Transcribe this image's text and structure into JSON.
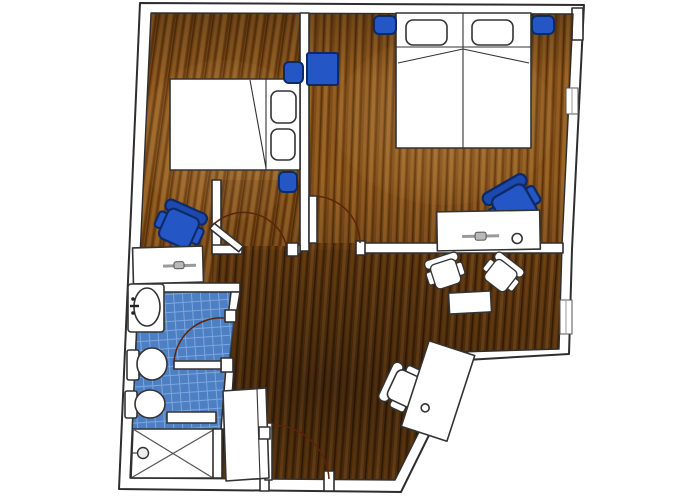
{
  "title": "apartment-floor-plan",
  "canvas": {
    "width": 700,
    "height": 500
  },
  "palette": {
    "wall_fill": "#ffffff",
    "wall_line": "#2e2e2e",
    "outline_dark": "#333333",
    "furniture_white": "#ffffff",
    "accent_blue": "#2456c6",
    "accent_blue_mid": "#1c49ad",
    "accent_blue_dark": "#0e2a66",
    "tile_base": "#4d7fc3",
    "tile_grid": "#7ea6dc",
    "wood_light_base": "#7f4d18",
    "wood_light_s1": "#935d22",
    "wood_light_s2": "#6a3a0e",
    "wood_light_s3": "#9a6527",
    "wood_light_s4": "#5c3309",
    "wood_dark_base": "#5b340e",
    "wood_dark_s1": "#6b4013",
    "wood_dark_s2": "#432406",
    "wood_dark_s3": "#74481a",
    "wood_dark_s4": "#371e05",
    "arc_color": "#5c2409",
    "handle_gray": "#9a9a9a"
  },
  "rooms": [
    {
      "id": "bedroom-left",
      "floor": "wood-light"
    },
    {
      "id": "bedroom-right",
      "floor": "wood-light"
    },
    {
      "id": "living-area",
      "floor": "wood-dark"
    },
    {
      "id": "hallway",
      "floor": "wood-dark"
    },
    {
      "id": "bathroom",
      "floor": "blue-tile"
    },
    {
      "id": "shower-stall",
      "floor": "white-tray"
    }
  ],
  "furniture": {
    "bedroom_left": [
      "double-bed",
      "pillow",
      "pillow",
      "nightstand",
      "nightstand",
      "desk",
      "office-chair-blue"
    ],
    "bedroom_right": [
      "twin-double-bed",
      "pillow",
      "pillow",
      "nightstand",
      "nightstand",
      "side-table-blue",
      "desk-with-lamp",
      "office-chair-blue"
    ],
    "living_area": [
      "armchair-white",
      "armchair-white",
      "coffee-table",
      "corner-desk",
      "desk-chair-white"
    ],
    "bathroom": [
      "sink-vanity",
      "toilet",
      "bidet",
      "shower-screen",
      "shower-head"
    ],
    "hallway": [
      "wardrobe-closet"
    ]
  },
  "doors": [
    {
      "id": "entrance-door",
      "location": "bottom-wall"
    },
    {
      "id": "bedroom-left-door",
      "location": "hall-to-left-bedroom"
    },
    {
      "id": "bedroom-right-door",
      "location": "living-to-right-bedroom"
    },
    {
      "id": "bathroom-door",
      "location": "hall-to-bathroom"
    }
  ],
  "windows": [
    {
      "id": "window-right-upper",
      "location": "right-wall"
    },
    {
      "id": "window-right-lower",
      "location": "right-wall"
    }
  ]
}
